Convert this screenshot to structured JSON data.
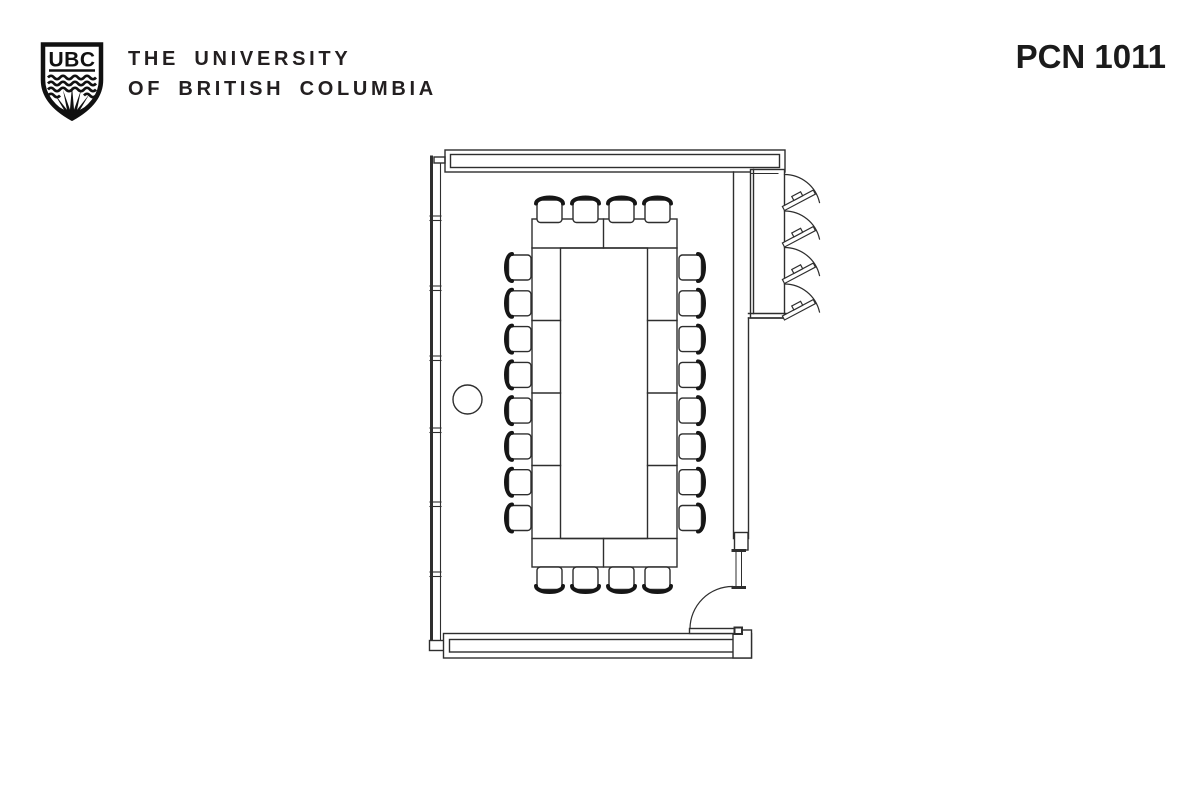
{
  "header": {
    "logo_letters": "UBC",
    "brand_line1": "THE UNIVERSITY",
    "brand_line2": "OF BRITISH COLUMBIA",
    "room_code": "PCN 1011"
  },
  "colors": {
    "ink": "#231f20",
    "plan_line": "#2e2e2e",
    "background": "#ffffff"
  },
  "floor_plan": {
    "room_code": "PCN 1011",
    "elements": {
      "conference_table_segments": 10,
      "chairs_total": 20,
      "chairs_top": 4,
      "chairs_bottom": 4,
      "chairs_left": 8,
      "chairs_right": 8,
      "casement_windows": 4,
      "entry_doors": 1,
      "columns": 1
    }
  }
}
